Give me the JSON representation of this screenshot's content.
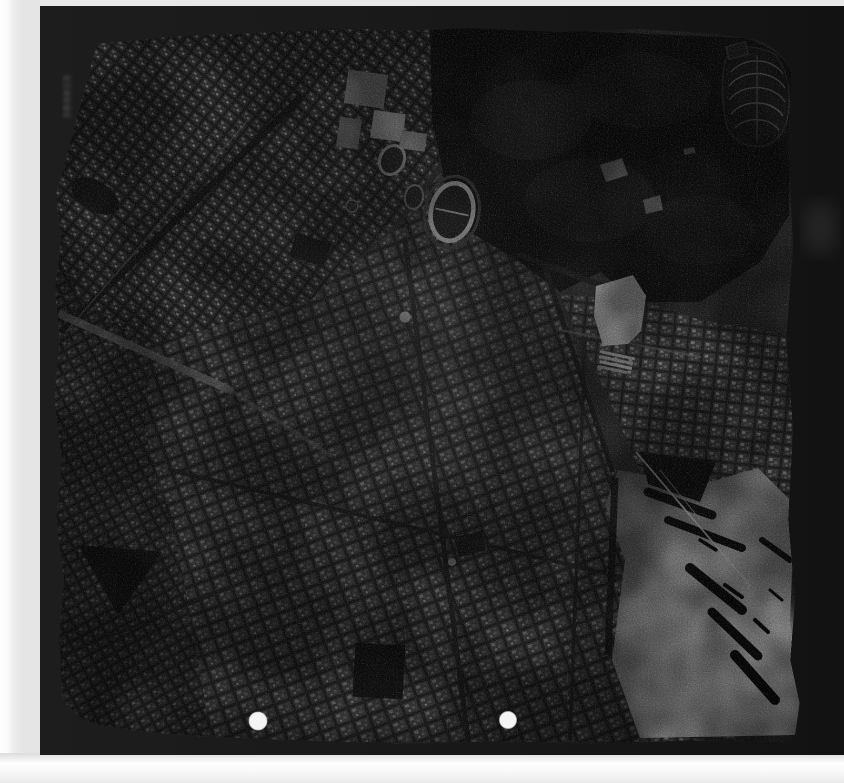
{
  "print": {
    "serial_marking": "304015",
    "kind": "black-and-white vertical aerial photograph film print",
    "punch_holes": 2
  },
  "colors": {
    "scan_background": "#e8e8e8",
    "film_frame": "#1a1a1a",
    "emulsion_base": "#3d3d3d",
    "quarry_clearing": "#ededed",
    "stadium_track": "#e2e2e2",
    "punch_hole": "#f4f4f4",
    "harbor_glint_bright": "#ffffff",
    "hills_dark": "#181818"
  },
  "features": {
    "landmarks": [
      "oval-stadium-track",
      "small-stadium",
      "training-track",
      "white-quarry-clearing",
      "circular-cemetery",
      "wooded-hills",
      "harbor-sun-glint",
      "harbor-piers-and-ships",
      "city-grid-districts",
      "railway-corridor",
      "punch-hole-left",
      "punch-hole-right",
      "film-serial-number"
    ]
  }
}
